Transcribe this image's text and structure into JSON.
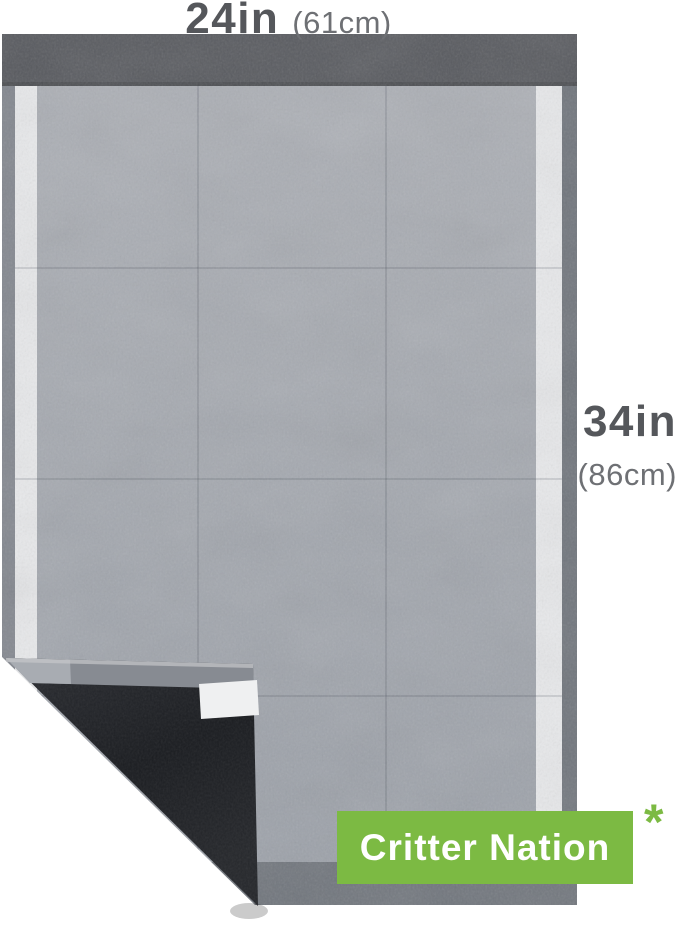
{
  "annotation": {
    "width_label": {
      "value": "24in",
      "metric": "(61cm)"
    },
    "height_label": {
      "value": "34in",
      "metric": "(86cm)"
    },
    "footnote_marker": "*"
  },
  "badge": {
    "label": "Critter Nation"
  },
  "colors": {
    "accent_green": "#7cba43",
    "label_dark": "#55575b",
    "label_light": "#6e7074",
    "pad_body_light": "#adb0b6",
    "pad_body_dark": "#9ba0a8",
    "pad_top_strip": "#57595e",
    "pad_white_strip": "#e8e9eb",
    "pad_left_border": "#82868e",
    "pad_right_border": "#6f747b",
    "pad_bottom_strip": "#6f747b",
    "flap_dark": "#2b2d32",
    "flap_darker": "#1b1d21",
    "fold_edge_gray": "#878b92",
    "tape_white": "#eff0f1",
    "badge_text": "#ffffff"
  }
}
